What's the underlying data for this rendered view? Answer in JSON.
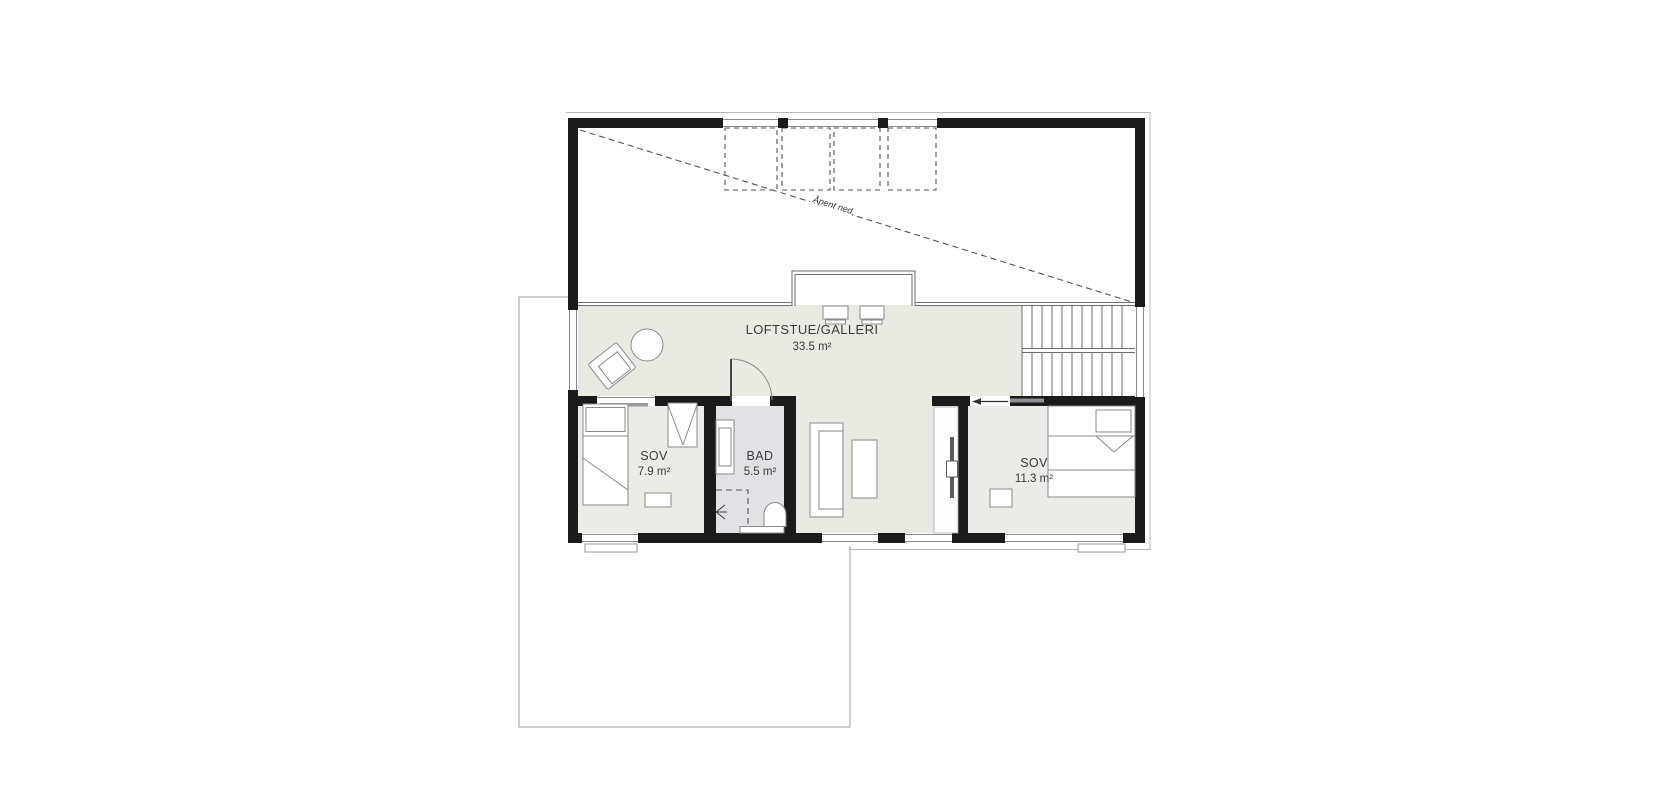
{
  "plan": {
    "type": "floor-plan",
    "floor": "loft",
    "annotations": {
      "open_below": "Åpent ned"
    },
    "rooms": {
      "loft": {
        "name": "LOFTSTUE/GALLERI",
        "area": "33.5 m²"
      },
      "sov1": {
        "name": "SOV",
        "area": "7.9 m²"
      },
      "bad": {
        "name": "BAD",
        "area": "5.5 m²"
      },
      "sov2": {
        "name": "SOV",
        "area": "11.3 m²"
      }
    },
    "colors": {
      "wall": "#1b1b1b",
      "floor": "#eaeae3",
      "floor_bath": "#e2e2e6",
      "structure_line": "#6e6e6e",
      "roof_outline": "#b8b8b8",
      "lower_floor_outline": "#adadad"
    }
  }
}
